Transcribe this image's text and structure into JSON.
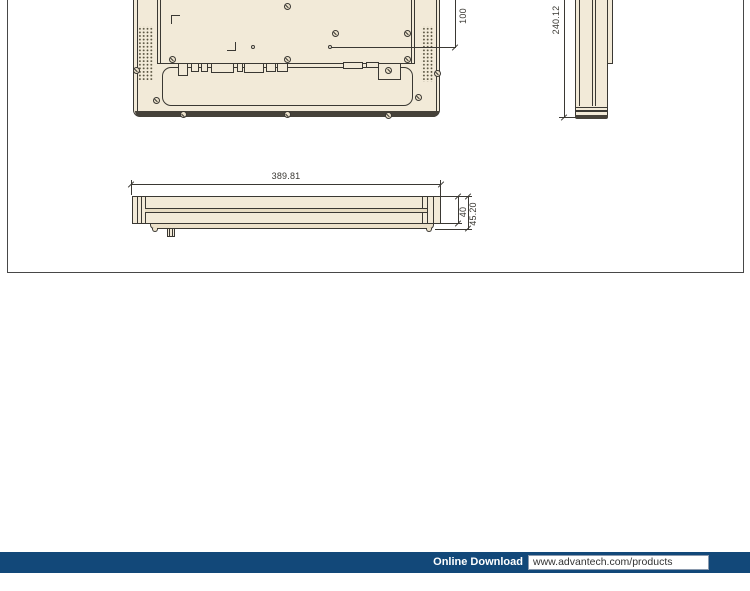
{
  "drawing": {
    "dims": {
      "vesa_spacing": "100",
      "height": "240.12",
      "width": "389.81",
      "depth_body": "40",
      "depth_total": "45.20"
    }
  },
  "footer": {
    "label": "Online Download",
    "url": "www.advantech.com/products"
  },
  "colors": {
    "footer_navy": "#124879",
    "drawing_fill": "#f2ead8",
    "drawing_line": "#3a3833",
    "frame_border": "#474747"
  }
}
